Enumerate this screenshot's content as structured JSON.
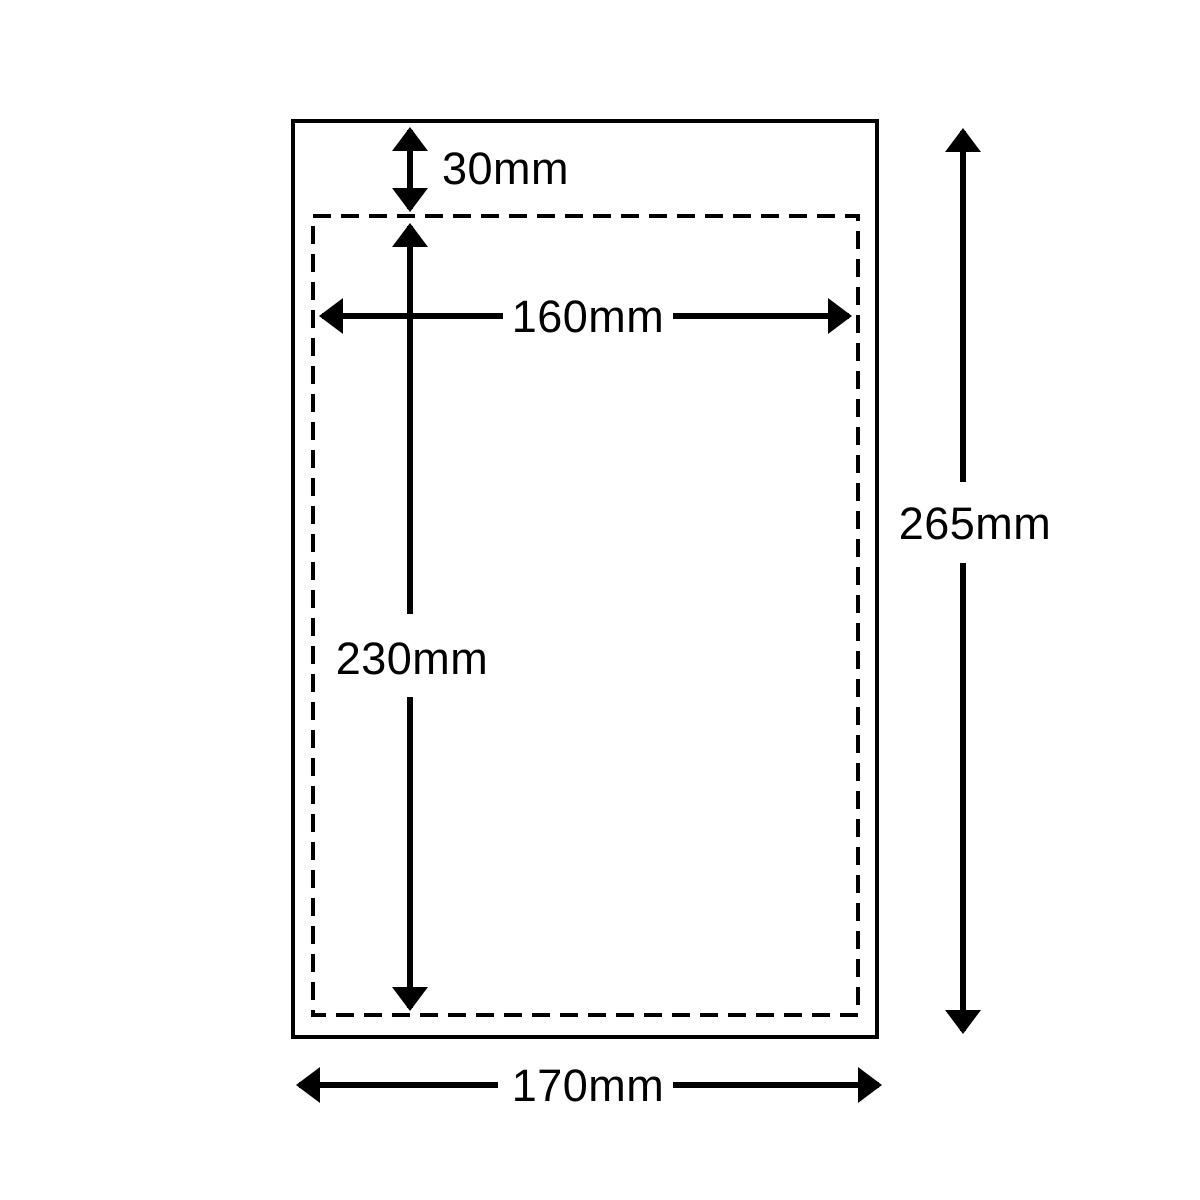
{
  "diagram": {
    "type": "dimension-diagram",
    "subject": "envelope-size-specification",
    "background_color": "#ffffff",
    "line_color": "#000000",
    "outer_box": {
      "style": "solid",
      "width_label": "170mm",
      "height_label": "265mm",
      "width_mm": 170,
      "height_mm": 265
    },
    "inner_box": {
      "style": "dashed",
      "width_label": "160mm",
      "height_label": "230mm",
      "top_offset_label": "30mm",
      "width_mm": 160,
      "height_mm": 230,
      "top_offset_mm": 30
    }
  }
}
